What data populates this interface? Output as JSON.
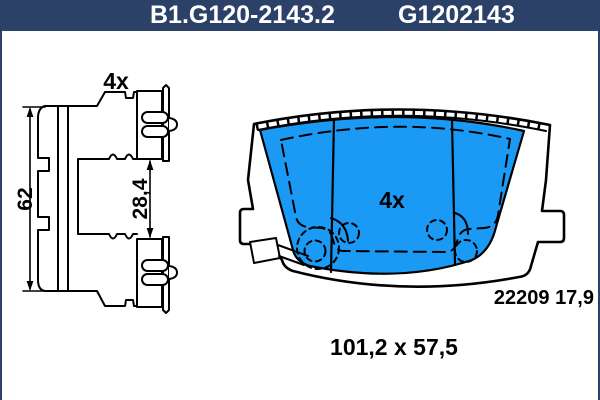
{
  "header": {
    "part_number": "B1.G120-2143.2",
    "catalog_number": "G1202143"
  },
  "side_view": {
    "quantity_label": "4x",
    "overall_height": "62",
    "clip_spacing": "28,4"
  },
  "front_view": {
    "quantity_label": "4x",
    "wva_and_thickness": "22209 17,9"
  },
  "footer": {
    "pad_dimensions": "101,2 x 57,5"
  },
  "colors": {
    "header_bg": "#2c4168",
    "header_text": "#ffffff",
    "pad_fill": "#1a9af5",
    "line_color": "#000000"
  }
}
